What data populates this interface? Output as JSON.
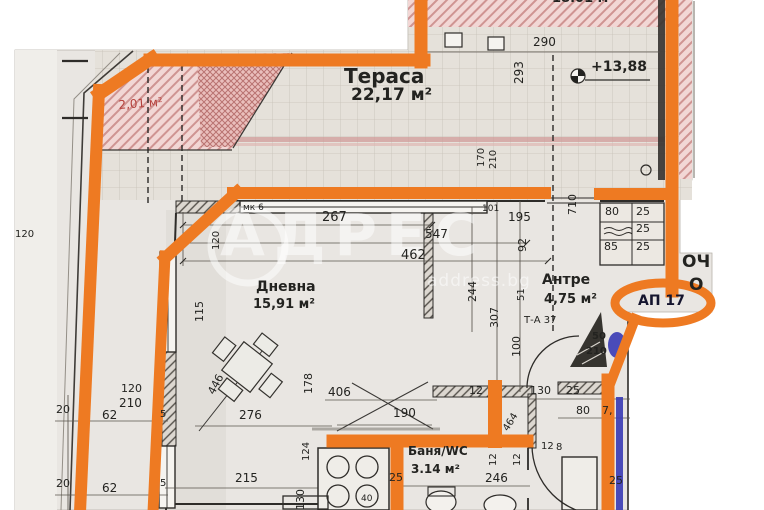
{
  "canvas": {
    "width": 764,
    "height": 510,
    "description": "scanned apartment floor plan with highlighted unit boundary"
  },
  "colors": {
    "accent_orange": "#ee7a22",
    "blue_marker": "#3c3eb5",
    "red_label": "#b5413c",
    "ink": "#232320",
    "badge_ink": "#15152e",
    "paper": "#e9e6e2",
    "watermark_white": "rgba(255,255,255,0.52)"
  },
  "watermark": {
    "brand": "АДРЕС",
    "site": "address.bg",
    "logo_letter": "А"
  },
  "badge": {
    "apartment": "АП 17"
  },
  "elevation": {
    "value": "+13,88"
  },
  "rooms": {
    "terrace": {
      "name": "Тераса",
      "area": "22,17 м²"
    },
    "living": {
      "name": "Дневна",
      "area": "15,91 м²"
    },
    "hall": {
      "name": "Антре",
      "area": "4,75 м²"
    },
    "bath": {
      "name": "Баня/WC",
      "area": "3.14 м²"
    },
    "neighbor": {
      "area": "18.01 м²"
    },
    "niche": {
      "area": "2,01 м²"
    }
  },
  "fragments": {
    "line1": "ОЧ",
    "line2": "О"
  },
  "labels": [
    {
      "n": "dim-290",
      "t": "290",
      "x": 533,
      "y": 36,
      "s": 12
    },
    {
      "n": "dim-293",
      "t": "293",
      "x": 513,
      "y": 84,
      "s": 12,
      "r": -90
    },
    {
      "n": "dim-170",
      "t": "170",
      "x": 477,
      "y": 167,
      "s": 10,
      "r": -90
    },
    {
      "n": "dim-210-terrace",
      "t": "210",
      "x": 489,
      "y": 169,
      "s": 10,
      "r": -90
    },
    {
      "n": "dim-710",
      "t": "710",
      "x": 567,
      "y": 215,
      "s": 11,
      "r": -90
    },
    {
      "n": "note-mk6",
      "t": "мк 6",
      "x": 243,
      "y": 204,
      "s": 9
    },
    {
      "n": "dim-267",
      "t": "267",
      "x": 322,
      "y": 211,
      "s": 13
    },
    {
      "n": "note-101",
      "t": "101",
      "x": 482,
      "y": 205,
      "s": 9
    },
    {
      "n": "dim-195",
      "t": "195",
      "x": 508,
      "y": 211,
      "s": 12
    },
    {
      "n": "dim-547",
      "t": "547",
      "x": 425,
      "y": 228,
      "s": 12
    },
    {
      "n": "dim-92",
      "t": "92",
      "x": 517,
      "y": 252,
      "s": 11,
      "r": -90
    },
    {
      "n": "dim-462",
      "t": "462",
      "x": 401,
      "y": 249,
      "s": 13
    },
    {
      "n": "dim-115",
      "t": "115",
      "x": 194,
      "y": 322,
      "s": 11,
      "r": -90
    },
    {
      "n": "dim-120-wall",
      "t": "120",
      "x": 212,
      "y": 250,
      "s": 10,
      "r": -90
    },
    {
      "n": "dim-244",
      "t": "244",
      "x": 467,
      "y": 302,
      "s": 11,
      "r": -90
    },
    {
      "n": "dim-307",
      "t": "307",
      "x": 489,
      "y": 328,
      "s": 11,
      "r": -90
    },
    {
      "n": "dim-51",
      "t": "51",
      "x": 517,
      "y": 301,
      "s": 10,
      "r": -90
    },
    {
      "n": "note-ta37",
      "t": "Т-А 37",
      "x": 524,
      "y": 316,
      "s": 10
    },
    {
      "n": "dim-100",
      "t": "100",
      "x": 511,
      "y": 357,
      "s": 11,
      "r": -90
    },
    {
      "n": "door-width-50",
      "t": "50",
      "x": 592,
      "y": 332,
      "s": 10,
      "b": 1
    },
    {
      "n": "door-height-210",
      "t": "210",
      "x": 586,
      "y": 347,
      "s": 10,
      "b": 1
    },
    {
      "n": "dim-20-a",
      "t": "20",
      "x": 56,
      "y": 404,
      "s": 11
    },
    {
      "n": "dim-62-a",
      "t": "62",
      "x": 102,
      "y": 409,
      "s": 12
    },
    {
      "n": "dim-120-a",
      "t": "120",
      "x": 121,
      "y": 383,
      "s": 11
    },
    {
      "n": "dim-210-a",
      "t": "210",
      "x": 119,
      "y": 397,
      "s": 12
    },
    {
      "n": "dim-5-a",
      "t": "5",
      "x": 160,
      "y": 410,
      "s": 10
    },
    {
      "n": "dim-20-b",
      "t": "20",
      "x": 56,
      "y": 478,
      "s": 11
    },
    {
      "n": "dim-62-b",
      "t": "62",
      "x": 102,
      "y": 482,
      "s": 12
    },
    {
      "n": "dim-5-b",
      "t": "5",
      "x": 160,
      "y": 479,
      "s": 10
    },
    {
      "n": "dim-120-margin",
      "t": "120",
      "x": 15,
      "y": 230,
      "s": 10
    },
    {
      "n": "dim-446",
      "t": "446",
      "x": 206,
      "y": 391,
      "s": 11,
      "r": -62
    },
    {
      "n": "dim-178",
      "t": "178",
      "x": 303,
      "y": 394,
      "s": 11,
      "r": -90
    },
    {
      "n": "dim-406",
      "t": "406",
      "x": 328,
      "y": 386,
      "s": 12
    },
    {
      "n": "dim-276",
      "t": "276",
      "x": 239,
      "y": 409,
      "s": 12
    },
    {
      "n": "dim-124",
      "t": "124",
      "x": 302,
      "y": 461,
      "s": 10,
      "r": -90
    },
    {
      "n": "dim-215",
      "t": "215",
      "x": 235,
      "y": 472,
      "s": 12
    },
    {
      "n": "dim-130-rot",
      "t": "130",
      "x": 295,
      "y": 510,
      "s": 11,
      "r": -90
    },
    {
      "n": "dim-190",
      "t": "190",
      "x": 393,
      "y": 407,
      "s": 12
    },
    {
      "n": "dim-40",
      "t": "40",
      "x": 361,
      "y": 495,
      "s": 9
    },
    {
      "n": "dim-12-a",
      "t": "12",
      "x": 469,
      "y": 385,
      "s": 11
    },
    {
      "n": "dim-130-b",
      "t": "130",
      "x": 530,
      "y": 385,
      "s": 11
    },
    {
      "n": "dim-25-a",
      "t": "25",
      "x": 566,
      "y": 385,
      "s": 11
    },
    {
      "n": "dim-464",
      "t": "464",
      "x": 502,
      "y": 428,
      "s": 10,
      "r": -58
    },
    {
      "n": "dim-80-a",
      "t": "80",
      "x": 576,
      "y": 405,
      "s": 11
    },
    {
      "n": "dim-7",
      "t": "7,",
      "x": 602,
      "y": 405,
      "s": 11
    },
    {
      "n": "dim-12-rot-a",
      "t": "12",
      "x": 489,
      "y": 466,
      "s": 10,
      "r": -90
    },
    {
      "n": "dim-12-rot-b",
      "t": "12",
      "x": 513,
      "y": 466,
      "s": 10,
      "r": -90
    },
    {
      "n": "dim-12-b",
      "t": "12",
      "x": 541,
      "y": 442,
      "s": 10
    },
    {
      "n": "dim-8",
      "t": "8",
      "x": 556,
      "y": 443,
      "s": 10
    },
    {
      "n": "dim-25-bath",
      "t": "25",
      "x": 389,
      "y": 472,
      "s": 11
    },
    {
      "n": "dim-246",
      "t": "246",
      "x": 485,
      "y": 472,
      "s": 12
    },
    {
      "n": "dim-25-c",
      "t": "25",
      "x": 609,
      "y": 475,
      "s": 11
    },
    {
      "n": "closet-80",
      "t": "80",
      "x": 605,
      "y": 206,
      "s": 11
    },
    {
      "n": "closet-25-a",
      "t": "25",
      "x": 636,
      "y": 206,
      "s": 11
    },
    {
      "n": "closet-25-b",
      "t": "25",
      "x": 636,
      "y": 223,
      "s": 11
    },
    {
      "n": "closet-85",
      "t": "85",
      "x": 604,
      "y": 241,
      "s": 11
    },
    {
      "n": "closet-25-c",
      "t": "25",
      "x": 636,
      "y": 241,
      "s": 11
    }
  ]
}
